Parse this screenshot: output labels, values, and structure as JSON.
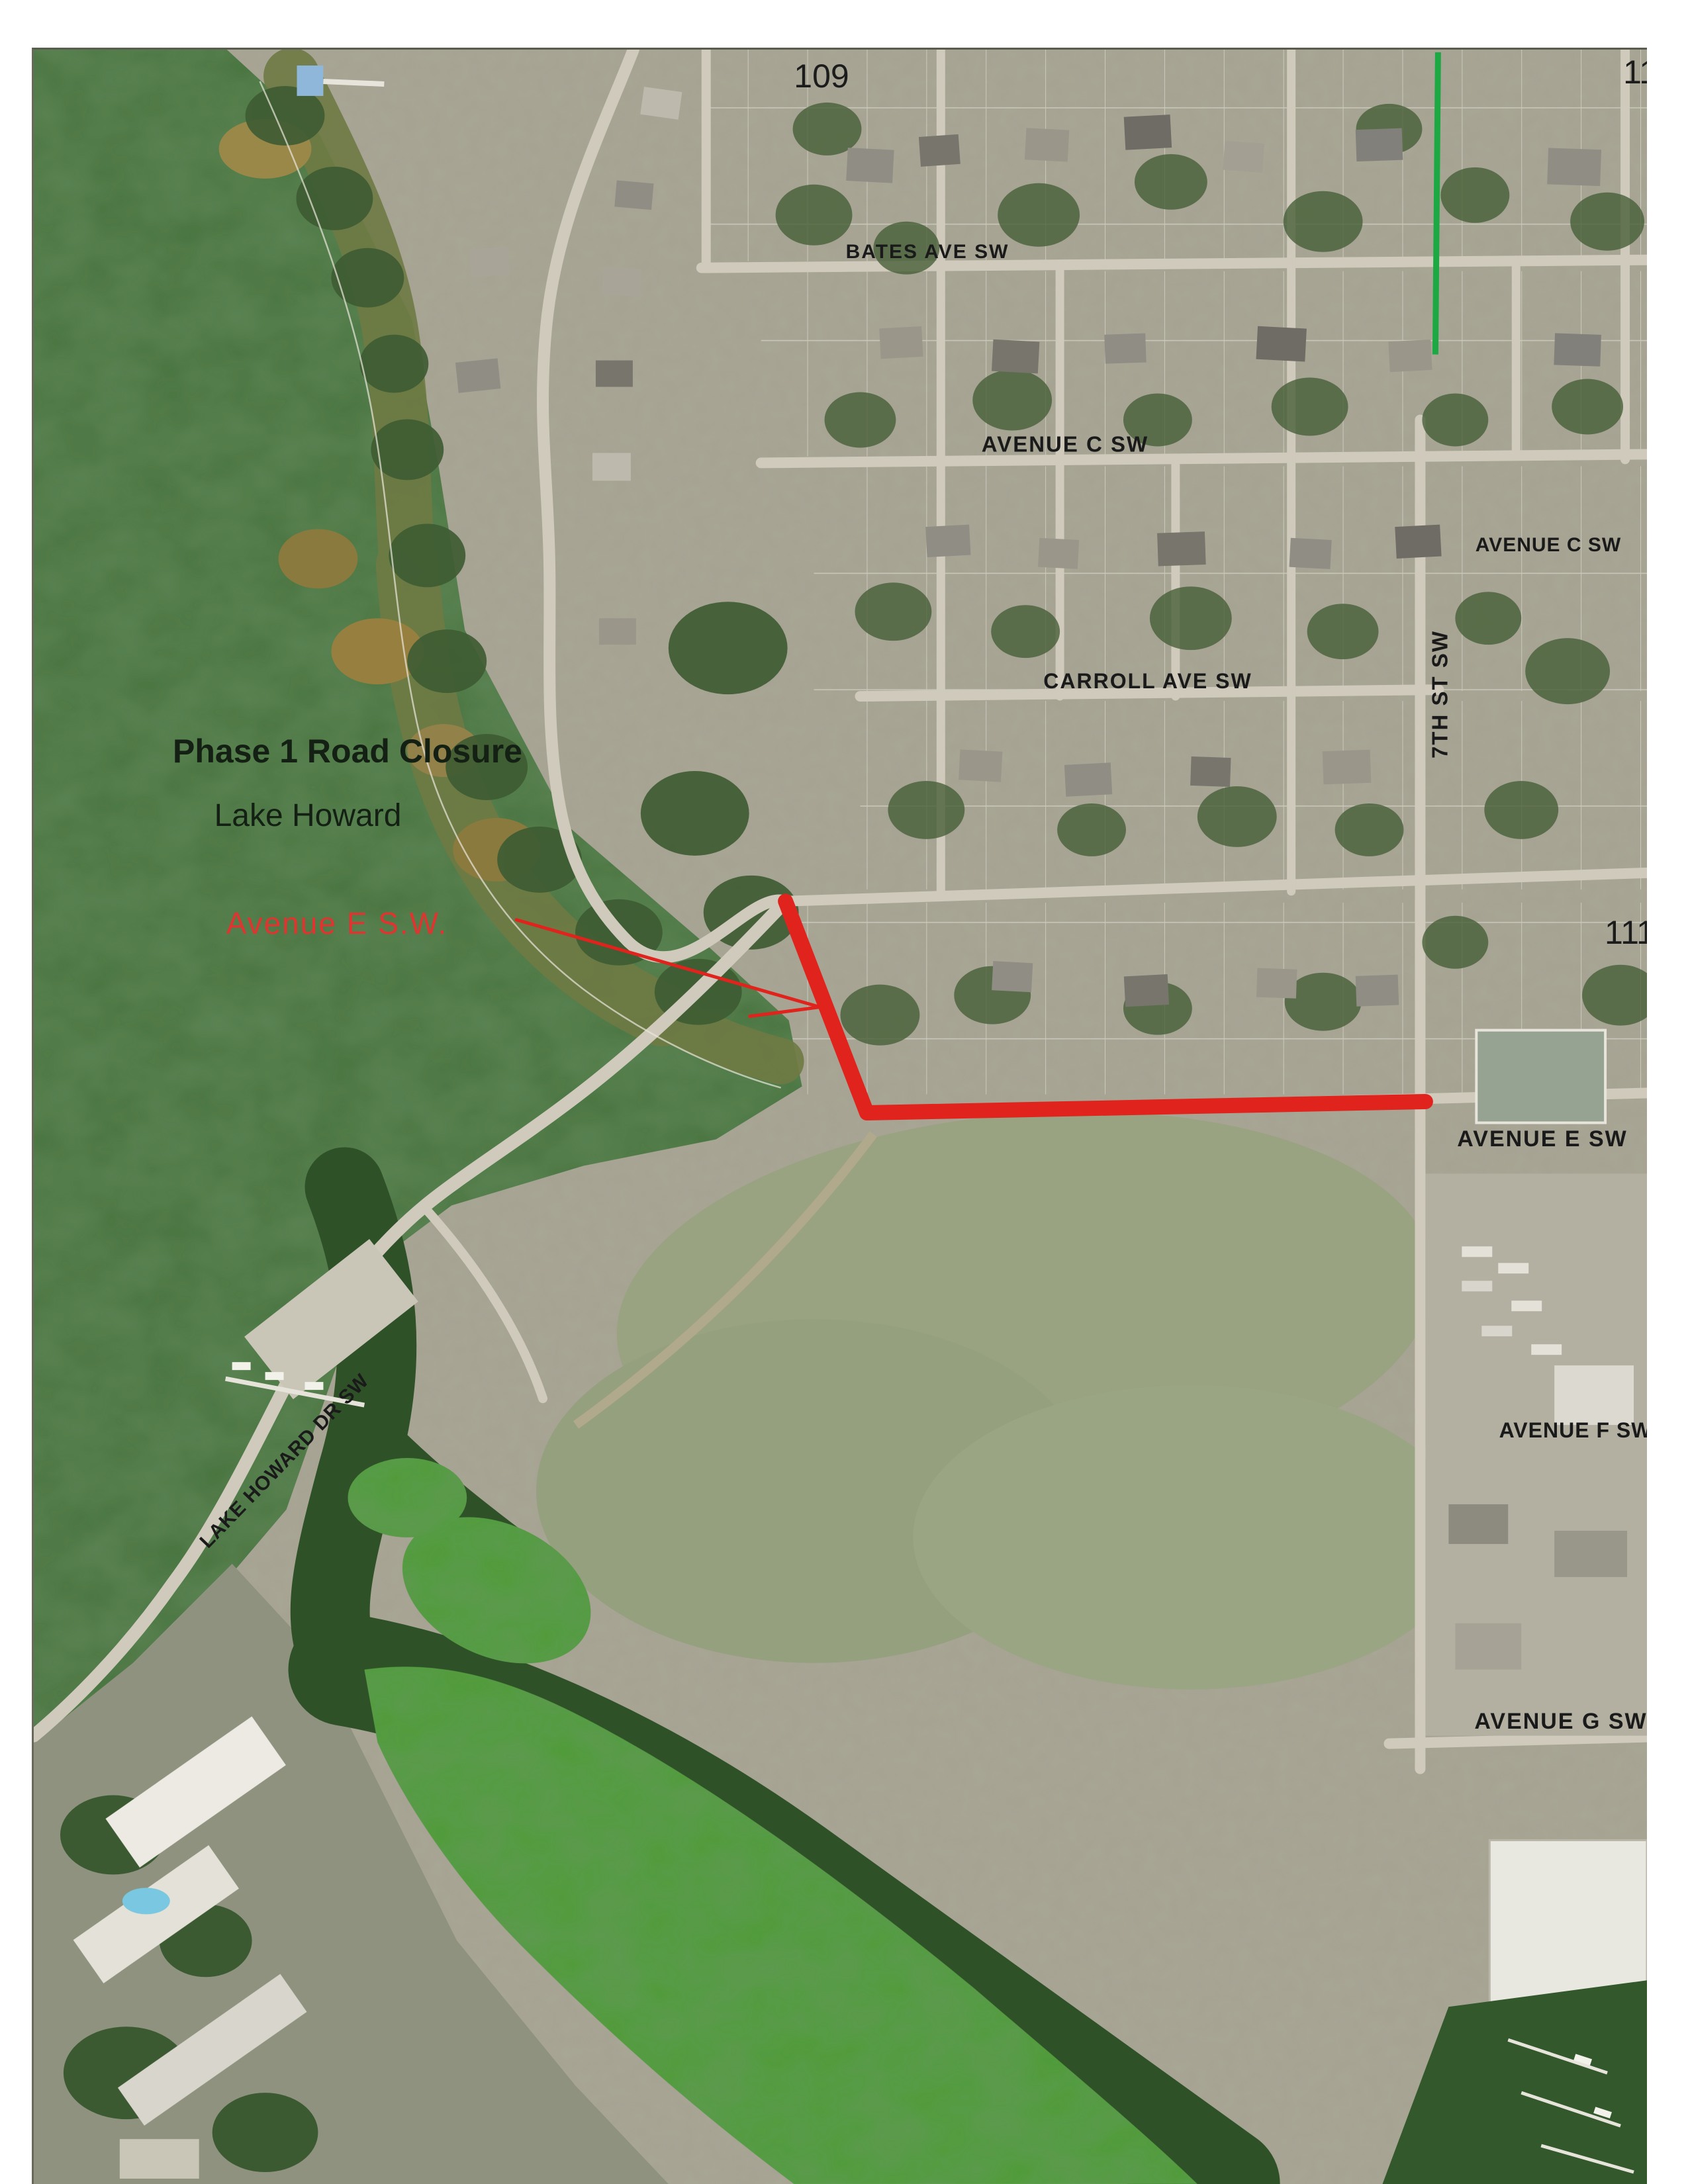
{
  "map": {
    "title": {
      "line1": "Phase 1 Road Closure",
      "line2": "Lake Howard"
    },
    "closure": {
      "label": "Avenue E S.W."
    },
    "streets": {
      "bates": "BATES AVE SW",
      "avenue_c_mid": "AVENUE C SW",
      "avenue_c_right": "AVENUE C SW",
      "carroll": "CARROLL AVE SW",
      "seventh": "7TH ST SW",
      "avenue_e": "AVENUE E SW",
      "avenue_f": "AVENUE F SW",
      "avenue_g": "AVENUE G SW",
      "lake_howard_dr": "LAKE HOWARD DR SW"
    },
    "parcels": {
      "n109": "109",
      "n110": "110",
      "n111": "111"
    },
    "colors": {
      "closure_red": "#e0231d",
      "label_red": "#e03430",
      "survey_green": "#1ca943",
      "title_ink": "#132013",
      "street_ink": "#1a1a1a"
    }
  }
}
